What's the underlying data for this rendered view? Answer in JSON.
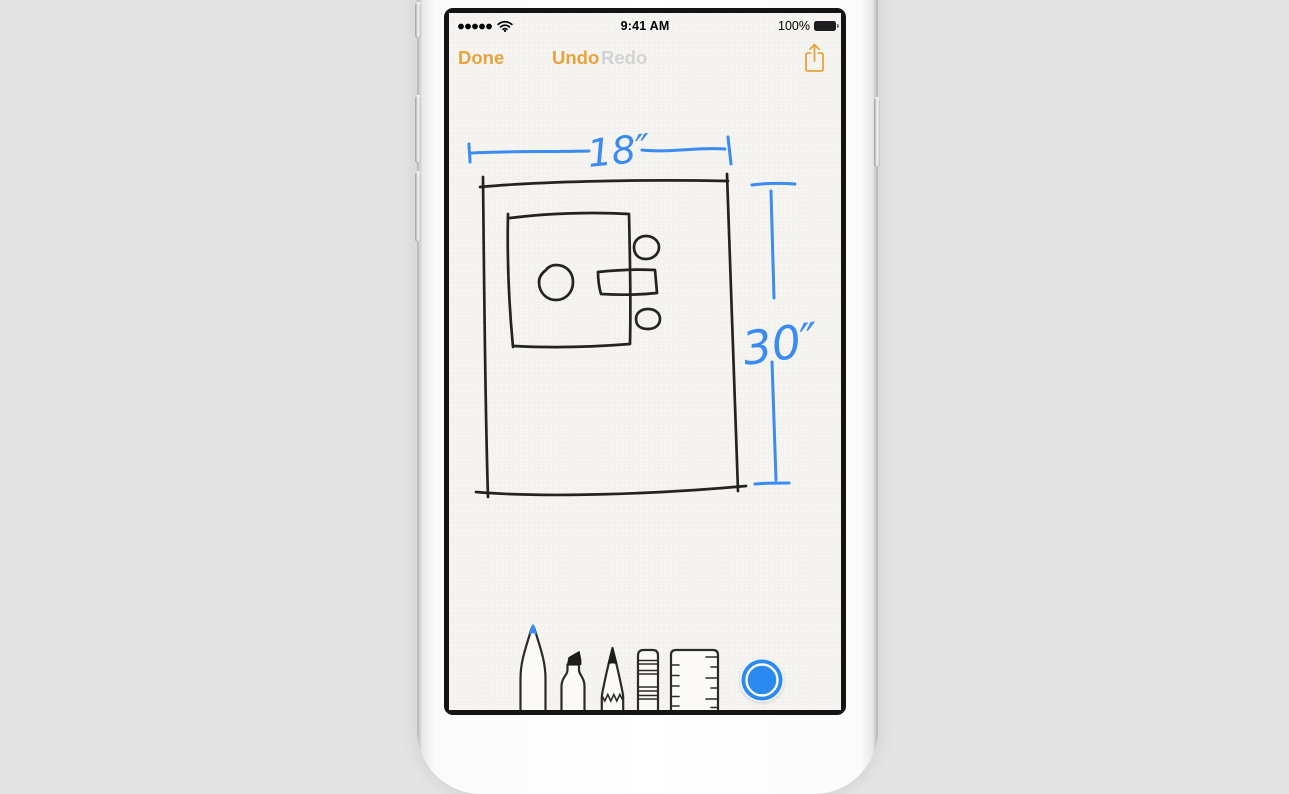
{
  "status_bar": {
    "signal_dots": 5,
    "time": "9:41 AM",
    "battery_percent": "100%"
  },
  "toolbar": {
    "done_label": "Done",
    "undo_label": "Undo",
    "redo_label": "Redo",
    "share_icon": "share-icon"
  },
  "sketch": {
    "width_label": "18″",
    "height_label": "30″",
    "ink_black": "#232323",
    "ink_blue": "#3a8bf2"
  },
  "tools": {
    "selected_color": "#2b8af0",
    "items": [
      {
        "id": "pen",
        "tip_color": "#3a8bf2",
        "selected": true
      },
      {
        "id": "marker",
        "selected": false
      },
      {
        "id": "pencil",
        "selected": false
      },
      {
        "id": "eraser",
        "selected": false
      },
      {
        "id": "ruler",
        "selected": false
      },
      {
        "id": "color-swatch",
        "value": "#2b8af0"
      }
    ]
  },
  "colors": {
    "accent_amber": "#e8a33c",
    "disabled_gray": "#d3d3d6",
    "paper": "#f5f4f0",
    "desk_background": "#e4e4e5"
  }
}
